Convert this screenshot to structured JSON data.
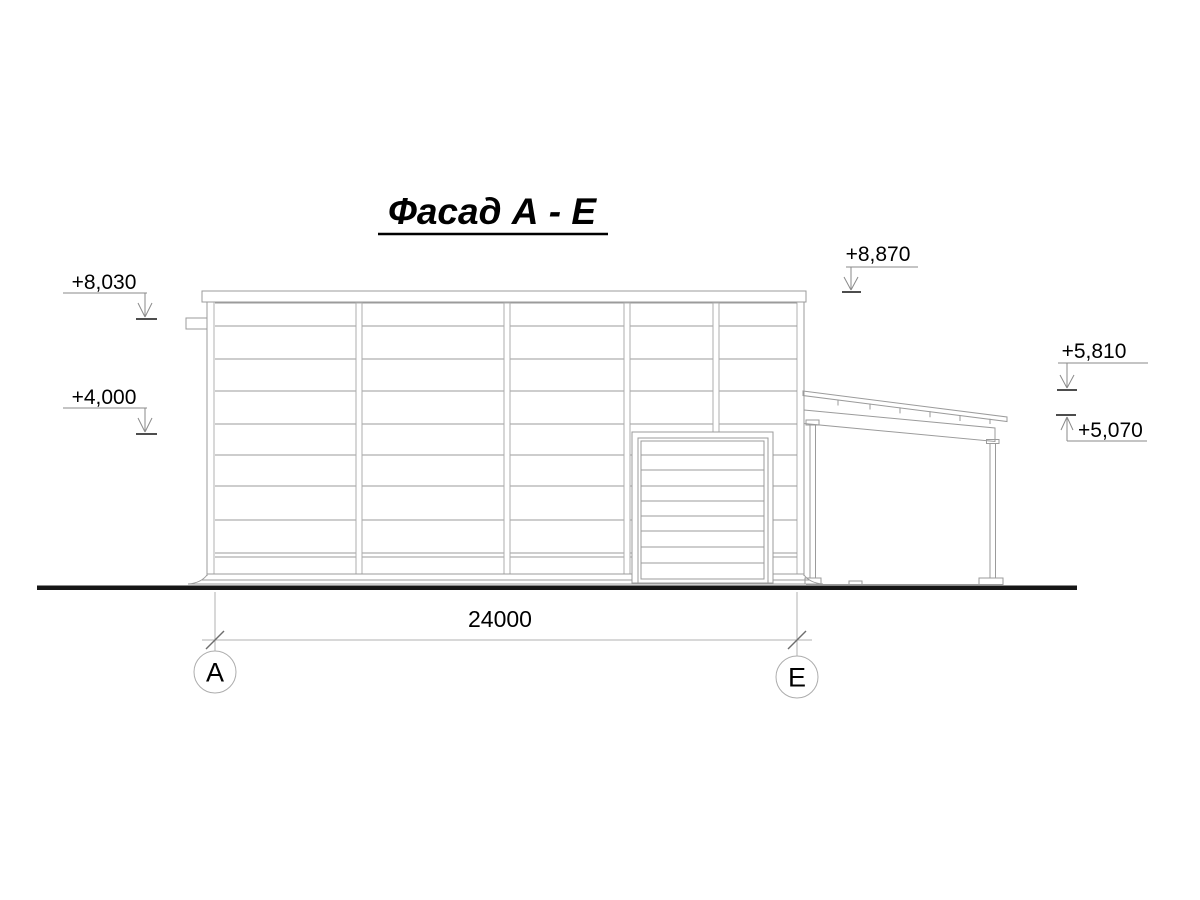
{
  "title": "Фасад А - Е",
  "elevations": {
    "left_top": "+8,030",
    "left_mid": "+4,000",
    "roof_main": "+8,870",
    "annex_high": "+5,810",
    "annex_low": "+5,070"
  },
  "dimension": {
    "overall": "24000"
  },
  "axes": {
    "left": "А",
    "right": "Е"
  },
  "colors": {
    "line_gray": "#9b9b9b",
    "line_light": "#b0b0b0",
    "ground_black": "#161616",
    "text_black": "#000000",
    "background": "#ffffff"
  }
}
